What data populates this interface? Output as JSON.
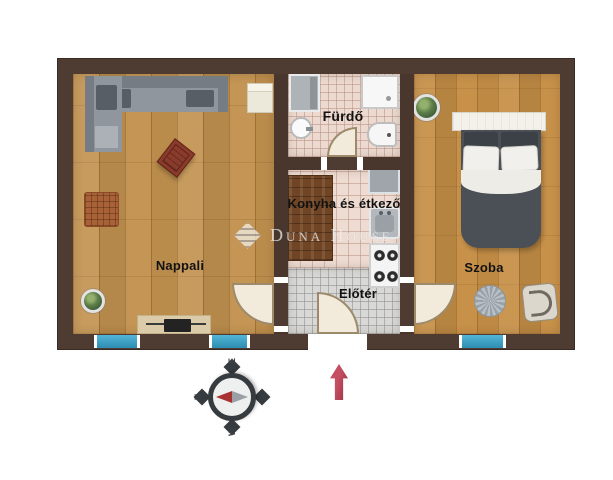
{
  "rooms": {
    "living": {
      "label": "Nappali"
    },
    "bathroom": {
      "label": "Fürdő"
    },
    "kitchen": {
      "label": "Konyha és étkező"
    },
    "hall": {
      "label": "Előtér"
    },
    "bedroom": {
      "label": "Szoba"
    }
  },
  "watermark": {
    "brand": "Duna House"
  },
  "compass": {
    "north": "N",
    "east": "E",
    "south": "S",
    "west": "W"
  },
  "colors": {
    "wall": "#4e3c33",
    "wood_floor_light": "#c2924f",
    "wood_floor_warm": "#c68f46",
    "tile_pink": "#ecdad0",
    "tile_gray": "#d8d8d6",
    "window": "#3d9fc4",
    "arrow_red": "#b23a4e"
  }
}
